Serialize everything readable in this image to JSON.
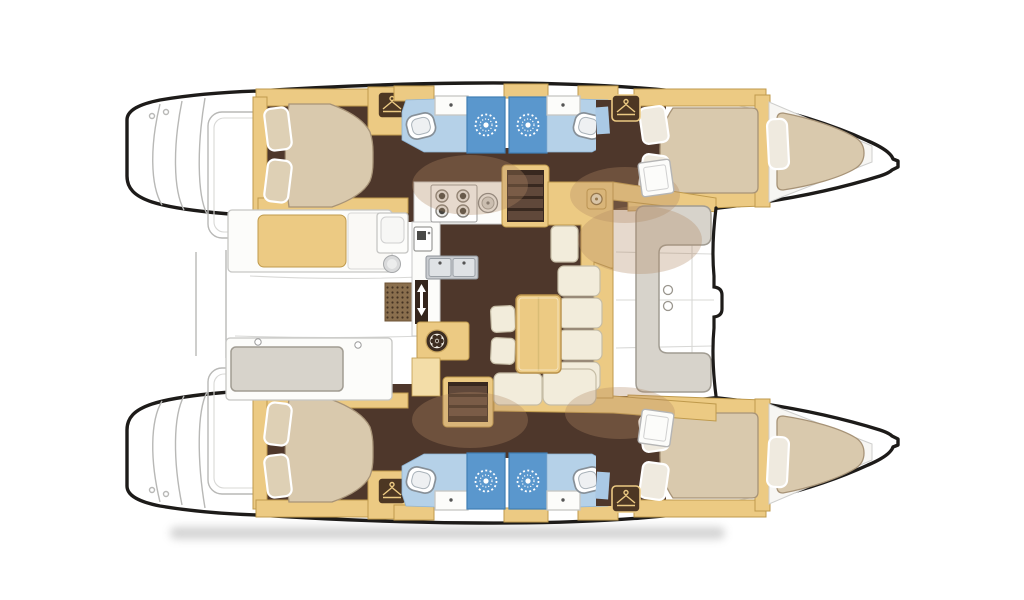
{
  "canvas": {
    "width": 1024,
    "height": 600,
    "background": "#ffffff"
  },
  "palette": {
    "outline": "#1d1b19",
    "deck_line": "#b8b8b6",
    "wood_tan": "#ecca83",
    "wood_tan_dark": "#bf9a4c",
    "wood_tan_light": "#f3dda8",
    "floor_brown": "#4e372b",
    "overlay_tan": "#b08a62",
    "mattress": "#d9c9ad",
    "mattress_edge": "#a79377",
    "pillow": "#ded0b5",
    "cream": "#f2ecdb",
    "cream_edge": "#c6bda6",
    "bath_blue": "#b5d1e8",
    "shower_blue": "#5a97cd",
    "shower_edge": "#3f7eb5",
    "seat_gray": "#d7d3cb",
    "seat_gray_edge": "#a19c92",
    "steel": "#c3c7cb",
    "steel_edge": "#8d9298",
    "white_soft": "#fcfcfa",
    "hanger_brown": "#4d3723",
    "stair_dark": "#38281f",
    "stair_step": "#60483a",
    "shadow": "#9e9e9e"
  },
  "inventory": {
    "double_cabins": 4,
    "heads": 4,
    "shower_stalls": 4,
    "forepeak_berths": 2,
    "hob_burners": 4,
    "cockpit_benches": 2
  },
  "icons": {
    "wardrobe": "clothes-hanger",
    "shower_rose": "sunburst",
    "stove": "four-burner-hob",
    "sink": "double-basin",
    "toilet": "rounded-bowl",
    "door": "up-down-slide-arrows",
    "washer": "drum-wheel",
    "stairs": "companionway-steps"
  },
  "areas": {
    "aft_cabin_port": {
      "label": "Aft double cabin (port hull)"
    },
    "fwd_cabin_port": {
      "label": "Forward double cabin (port hull)"
    },
    "aft_cabin_stbd": {
      "label": "Aft double cabin (starboard hull)"
    },
    "fwd_cabin_stbd": {
      "label": "Forward double cabin (starboard hull)"
    },
    "forepeak_port": {
      "label": "Forepeak berth (port bow)"
    },
    "forepeak_stbd": {
      "label": "Forepeak berth (starboard bow)"
    },
    "head_aft_port": {
      "label": "Aft head - toilet, basin and shower (port)"
    },
    "head_fwd_port": {
      "label": "Forward head - toilet, basin and shower (port)"
    },
    "head_aft_stbd": {
      "label": "Aft head - toilet, basin and shower (starboard)"
    },
    "head_fwd_stbd": {
      "label": "Forward head - toilet, basin and shower (starboard)"
    },
    "galley": {
      "label": "Galley - hob, double sink and fridge"
    },
    "salon": {
      "label": "Saloon - L-shaped sofa and table"
    },
    "nav": {
      "label": "Chart table / nav station"
    },
    "cockpit": {
      "label": "Aft cockpit - bench seating"
    },
    "fwd_cockpit": {
      "label": "Forward cockpit seat"
    },
    "transom_port": {
      "label": "Transom steps and swim platform (port)"
    },
    "transom_stbd": {
      "label": "Transom steps and swim platform (starboard)"
    },
    "stairs_port": {
      "label": "Companionway to port hull"
    },
    "stairs_stbd": {
      "label": "Companionway to starboard hull"
    }
  }
}
